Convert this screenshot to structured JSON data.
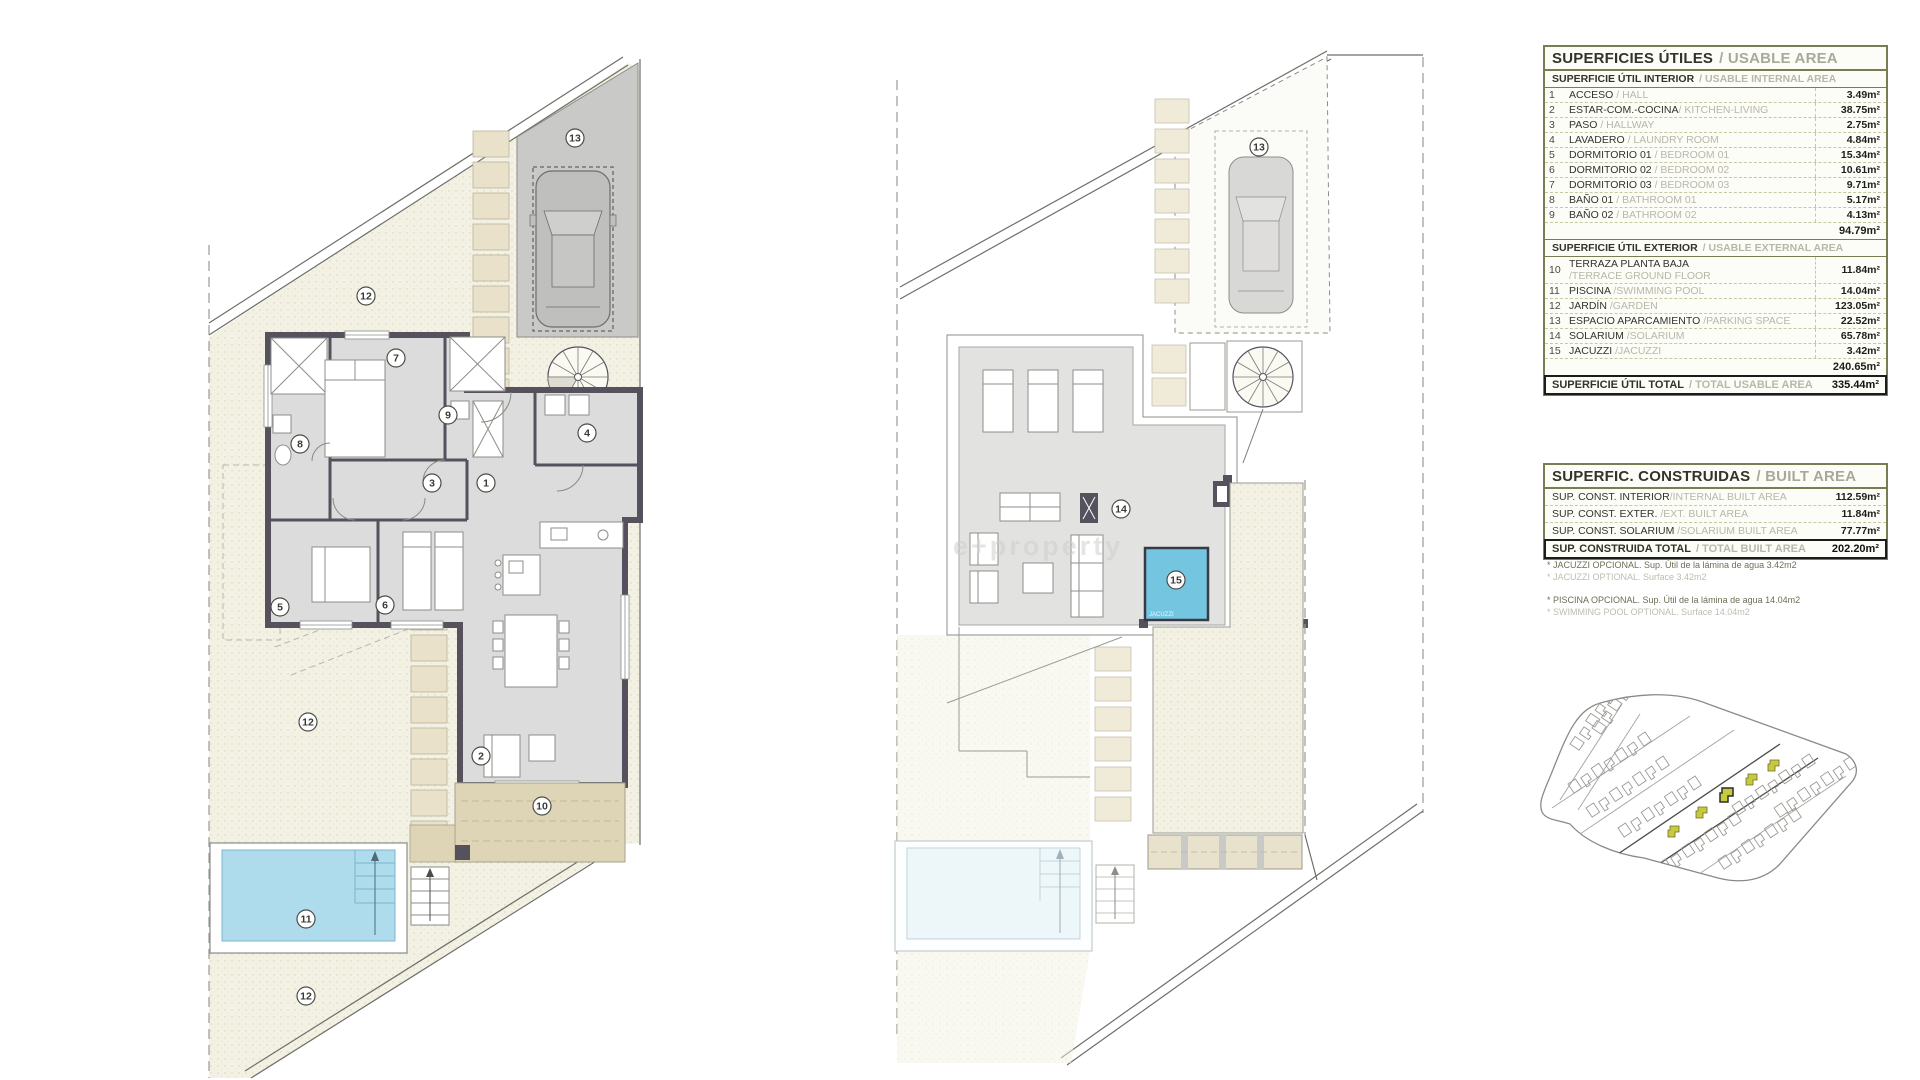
{
  "usable": {
    "title_es": "SUPERFICIES ÚTILES",
    "title_en": "/ USABLE AREA",
    "interior_header_es": "SUPERFICIE ÚTIL INTERIOR",
    "interior_header_en": "/ USABLE INTERNAL AREA",
    "interior_rows": [
      {
        "num": "1",
        "es": "ACCESO",
        "en": "/ HALL",
        "val": "3.49m²"
      },
      {
        "num": "2",
        "es": "ESTAR-COM.-COCINA",
        "en": "/ KITCHEN-LIVING",
        "val": "38.75m²"
      },
      {
        "num": "3",
        "es": "PASO",
        "en": "/ HALLWAY",
        "val": "2.75m²"
      },
      {
        "num": "4",
        "es": "LAVADERO",
        "en": "/ LAUNDRY ROOM",
        "val": "4.84m²"
      },
      {
        "num": "5",
        "es": "DORMITORIO 01",
        "en": "/ BEDROOM 01",
        "val": "15.34m²"
      },
      {
        "num": "6",
        "es": "DORMITORIO 02",
        "en": "/ BEDROOM 02",
        "val": "10.61m²"
      },
      {
        "num": "7",
        "es": "DORMITORIO 03",
        "en": "/ BEDROOM 03",
        "val": "9.71m²"
      },
      {
        "num": "8",
        "es": "BAÑO 01",
        "en": "/ BATHROOM 01",
        "val": "5.17m²"
      },
      {
        "num": "9",
        "es": "BAÑO 02",
        "en": "/ BATHROOM 02",
        "val": "4.13m²"
      }
    ],
    "interior_subtotal": "94.79m²",
    "exterior_header_es": "SUPERFICIE ÚTIL EXTERIOR",
    "exterior_header_en": "/ USABLE EXTERNAL AREA",
    "exterior_rows": [
      {
        "num": "10",
        "es": "TERRAZA PLANTA BAJA",
        "en": "/TERRACE GROUND FLOOR",
        "val": "11.84m²"
      },
      {
        "num": "11",
        "es": "PISCINA",
        "en": "/SWIMMING POOL",
        "val": "14.04m²"
      },
      {
        "num": "12",
        "es": "JARDÍN",
        "en": "/GARDEN",
        "val": "123.05m²"
      },
      {
        "num": "13",
        "es": "ESPACIO APARCAMIENTO",
        "en": "/PARKING SPACE",
        "val": "22.52m²"
      },
      {
        "num": "14",
        "es": "SOLARIUM",
        "en": "/SOLARIUM",
        "val": "65.78m²"
      },
      {
        "num": "15",
        "es": "JACUZZI",
        "en": "/JACUZZI",
        "val": "3.42m²"
      }
    ],
    "exterior_subtotal": "240.65m²",
    "total_es": "SUPERFICIE ÚTIL TOTAL",
    "total_en": "/ TOTAL USABLE AREA",
    "total_val": "335.44m²"
  },
  "built": {
    "title_es": "SUPERFIC. CONSTRUIDAS",
    "title_en": "/ BUILT AREA",
    "rows": [
      {
        "es": "SUP. CONST. INTERIOR",
        "en": "/INTERNAL BUILT AREA",
        "val": "112.59m²"
      },
      {
        "es": "SUP. CONST. EXTER.",
        "en": "/EXT. BUILT AREA",
        "val": "11.84m²"
      },
      {
        "es": "SUP. CONST. SOLARIUM",
        "en": "/SOLARIUM BUILT AREA",
        "val": "77.77m²"
      }
    ],
    "total_es": "SUP. CONSTRUIDA TOTAL",
    "total_en": "/ TOTAL BUILT AREA",
    "total_val": "202.20m²"
  },
  "footnotes": [
    {
      "es": "* JACUZZI OPCIONAL. Sup. Útil de la lámina de agua 3.42m2",
      "en": "* JACUZZI OPTIONAL. Surface 3.42m2"
    },
    {
      "es": "* PISCINA OPCIONAL. Sup. Útil de la lámina de agua 14.04m2",
      "en": "* SWIMMING POOL OPTIONAL. Surface 14.04m2"
    }
  ],
  "plans": {
    "ground_labels": [
      "13",
      "12",
      "7",
      "9",
      "8",
      "4",
      "3",
      "1",
      "5",
      "6",
      "12",
      "2",
      "10",
      "11",
      "12"
    ],
    "solarium_labels": [
      "13",
      "14",
      "15"
    ],
    "jacuzzi_text": "JACUZZI"
  },
  "watermark": "e+property",
  "colors": {
    "table_border": "#7b7b54",
    "text_dark": "#2a2a26",
    "text_muted": "#b7b7aa",
    "wall": "#55525e",
    "pool_water": "#aedcec",
    "jacuzzi": "#74c6e0",
    "terrace": "#ded4b6",
    "parking": "#c9c9c7",
    "stones": "#e9e1c9",
    "plot_highlight": "#c6ca3c"
  }
}
